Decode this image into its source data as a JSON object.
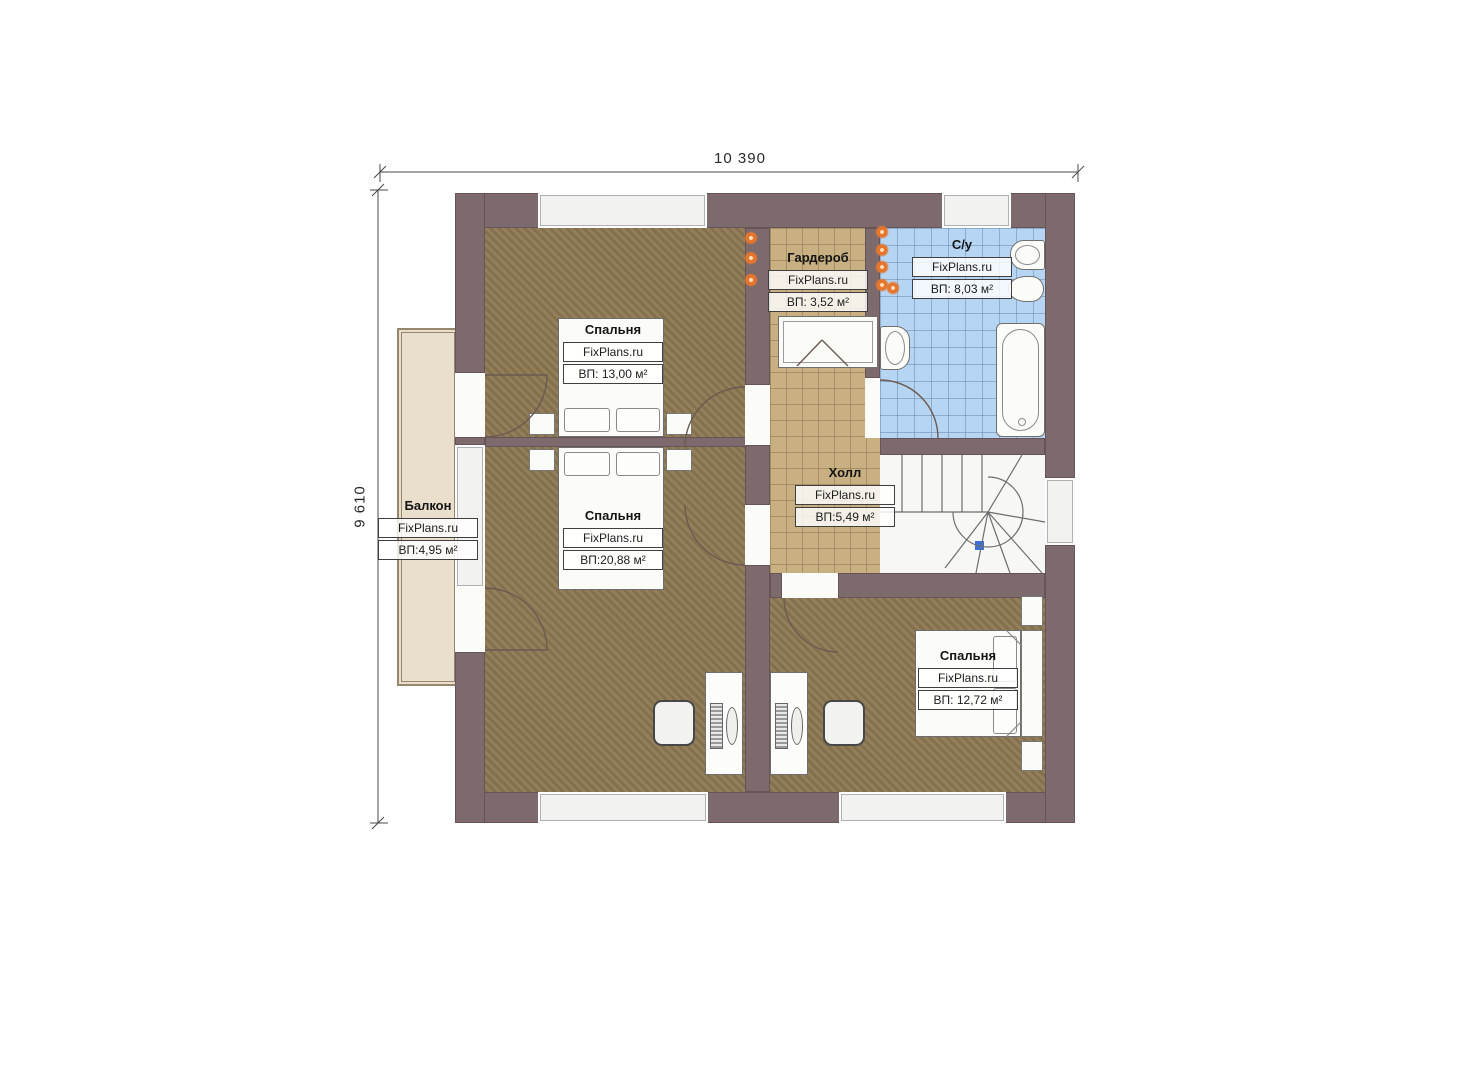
{
  "plan": {
    "title": "Floor plan (second floor)",
    "dimensions": {
      "width_label": "10 390",
      "height_label": "9 610"
    },
    "rooms": [
      {
        "id": "bedroom-top",
        "name": "Спальня",
        "brand": "FixPlans.ru",
        "area": "ВП: 13,00 м²"
      },
      {
        "id": "wardrobe",
        "name": "Гардероб",
        "brand": "FixPlans.ru",
        "area": "ВП: 3,52 м²"
      },
      {
        "id": "bathroom",
        "name": "С/у",
        "brand": "FixPlans.ru",
        "area": "ВП: 8,03 м²"
      },
      {
        "id": "bedroom-middle",
        "name": "Спальня",
        "brand": "FixPlans.ru",
        "area": "ВП:20,88 м²"
      },
      {
        "id": "hall",
        "name": "Холл",
        "brand": "FixPlans.ru",
        "area": "ВП:5,49 м²"
      },
      {
        "id": "balcony",
        "name": "Балкон",
        "brand": "FixPlans.ru",
        "area": "ВП:4,95 м²"
      },
      {
        "id": "bedroom-bottom",
        "name": "Спальня",
        "brand": "FixPlans.ru",
        "area": "ВП: 12,72 м²"
      }
    ],
    "colors": {
      "wall": "#7d6a6d",
      "wood_floor": "#8d7853",
      "tile_tan": "#c9b083",
      "tile_blue": "#b6d5f2",
      "balcony_floor": "#eadfcc",
      "light_dot": "#e4762e",
      "stair_marker": "#3a6fd8"
    }
  }
}
